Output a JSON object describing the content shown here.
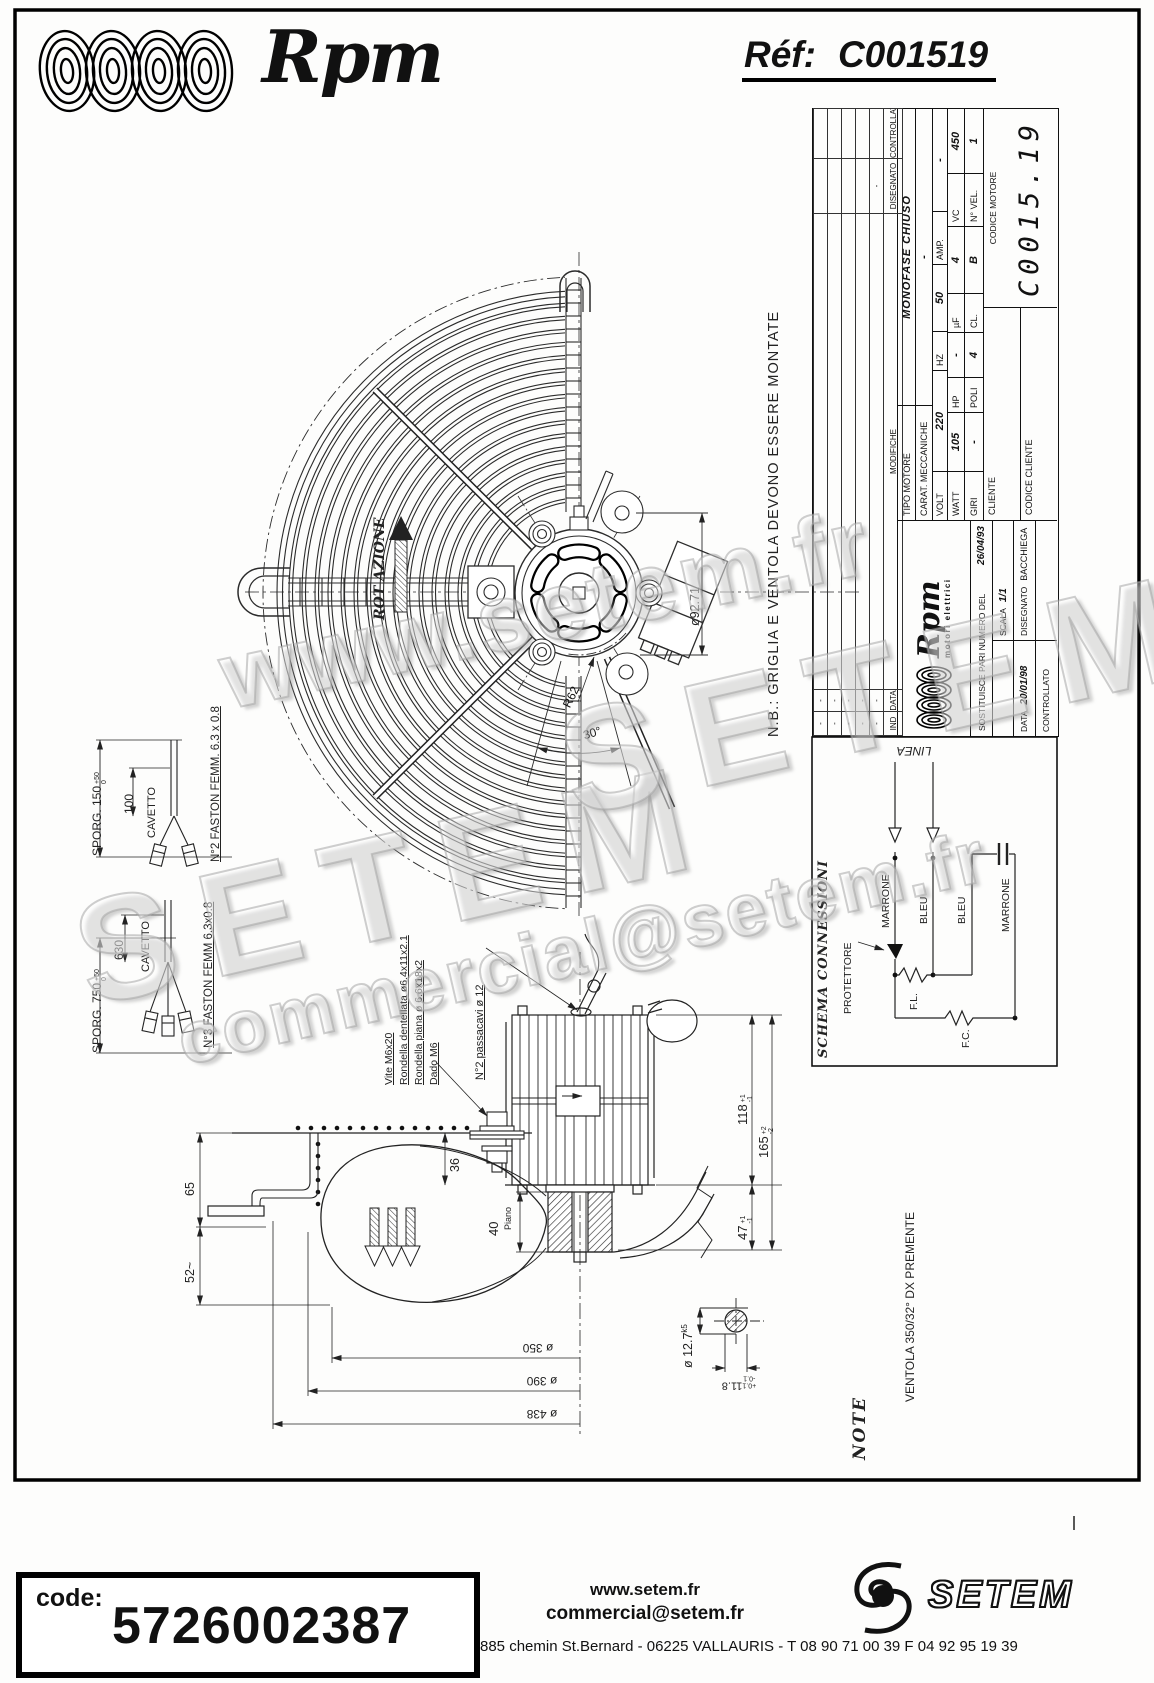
{
  "header": {
    "brand": "Rpm",
    "ref_label": "Réf:",
    "ref_value": "C001519"
  },
  "watermarks": {
    "w1": "www.setem.fr",
    "w2": "SETEM",
    "w3": "SETEM",
    "w4": "commercial@setem.fr"
  },
  "drawing": {
    "nb_note": "N.B.: GRIGLIA E VENTOLA DEVONO ESSERE MONTATE",
    "rotation_label": "ROT AZIONE",
    "bolt_circle_dim": "ø92.71",
    "radius_label": "R62",
    "angle_label": "30°",
    "ventola_label": "VENTOLA  350/32°  DX  PREMENTE",
    "note_label": "NOTE"
  },
  "cable_detail_a": {
    "sporg": "SPORG. 150",
    "tol_plus": "+50",
    "tol_minus": "0",
    "length": "100",
    "cavetto": "CAVETTO",
    "faston": "N°2 FASTON FEMM. 6.3 x 0.8"
  },
  "cable_detail_b": {
    "sporg": "SPORG. 750",
    "tol_plus": "+50",
    "tol_minus": "0",
    "length": "630",
    "cavetto": "CAVETTO",
    "faston": "N°3 FASTON FEMM 6.3x0.8"
  },
  "side_view": {
    "part_labels": {
      "vite": "Vite M6x20",
      "rondella_dentellata": "Rondella dentellata ø6.4x11x2.1",
      "rondella_piana": "Rondella piana ø 6.6x18x2",
      "dado": "Dado M6"
    },
    "passacavi": "N°2 passacavi ø 12",
    "dims": {
      "d36": "36",
      "d65": "65",
      "d52": "52~",
      "d40": "40",
      "piano": "Piano",
      "d47": "47",
      "d47_sup": "+1",
      "d47_sub": "-1",
      "d118": "118",
      "d118_sup": "+1",
      "d118_sub": "-1",
      "d165": "165",
      "d165_sup": "+2",
      "d165_sub": "-2",
      "d350": "ø 350",
      "d390": "ø 390",
      "d438": "ø 438",
      "shaft": "ø 12.7",
      "shaft_tol": "k5",
      "key": "11.8",
      "key_sup": "+0.1",
      "key_sub": "-0.1"
    }
  },
  "title_block": {
    "revision": {
      "headers": [
        "IND",
        "DATA",
        "MODIFICHE",
        "DISEGNATO",
        "CONTROLLATO"
      ],
      "rows": [
        {
          "ind": "-",
          "data": "-",
          "mod": "",
          "dis": "",
          "con": ""
        },
        {
          "ind": "-",
          "data": "-",
          "mod": "",
          "dis": "",
          "con": ""
        },
        {
          "ind": "-",
          "data": "-",
          "mod": "",
          "dis": "",
          "con": ""
        },
        {
          "ind": "-",
          "data": "-",
          "mod": "",
          "dis": "",
          "con": ""
        },
        {
          "ind": "-",
          "data": "-",
          "mod": "",
          "dis": "-",
          "con": ""
        }
      ]
    },
    "logo": {
      "name": "Rpm",
      "sub": "motori elettrici"
    },
    "sostituisce_label": "SOSTITUISCE PARI NUMERO DEL",
    "sostituisce_value": "26/04/93",
    "scala_label": "SCALA",
    "scala_value": "1/1",
    "data_label": "DATA",
    "data_value": "20/01/98",
    "disegnato_label": "DISEGNATO",
    "disegnato_value": "BACCHIEGA",
    "controllato_label": "CONTROLLATO",
    "tipo_label": "TIPO MOTORE",
    "tipo_value": "MONOFASE CHIUSO",
    "carat_label": "CARAT. MECCANICHE",
    "carat_value": "-",
    "specs1": [
      {
        "l": "VOLT",
        "v": "220"
      },
      {
        "l": "HZ",
        "v": "50"
      },
      {
        "l": "AMP.",
        "v": "-"
      }
    ],
    "specs2": [
      {
        "l": "WATT",
        "v": "105"
      },
      {
        "l": "HP",
        "v": "-"
      },
      {
        "l": "µF",
        "v": "4"
      },
      {
        "l": "VC",
        "v": "450"
      }
    ],
    "specs3": [
      {
        "l": "GIRI",
        "v": "-"
      },
      {
        "l": "POLI",
        "v": "4"
      },
      {
        "l": "CL.",
        "v": "B"
      },
      {
        "l": "N° VEL.",
        "v": "1"
      }
    ],
    "cliente_label": "CLIENTE",
    "codice_motore_label": "CODICE MOTORE",
    "codice_motore_value": "C0015.19",
    "codice_cliente_label": "CODICE CLIENTE"
  },
  "schema": {
    "title": "SCHEMA CONNESSIONI",
    "linea": "LINEA",
    "marrone_1": "MARRONE",
    "bleu_1": "BLEU",
    "bleu_2": "BLEU",
    "marrone_2": "MARRONE",
    "protettore": "PROTETTORE",
    "fl": "F.L.",
    "fc": "F.C."
  },
  "footer": {
    "code_label": "code:",
    "code_value": "5726002387",
    "website": "www.setem.fr",
    "email": "commercial@setem.fr",
    "address": "885 chemin St.Bernard  -  06225 VALLAURIS  -  T 08 90 71 00 39   F 04 92 95 19 39",
    "brand": "SETEM"
  }
}
